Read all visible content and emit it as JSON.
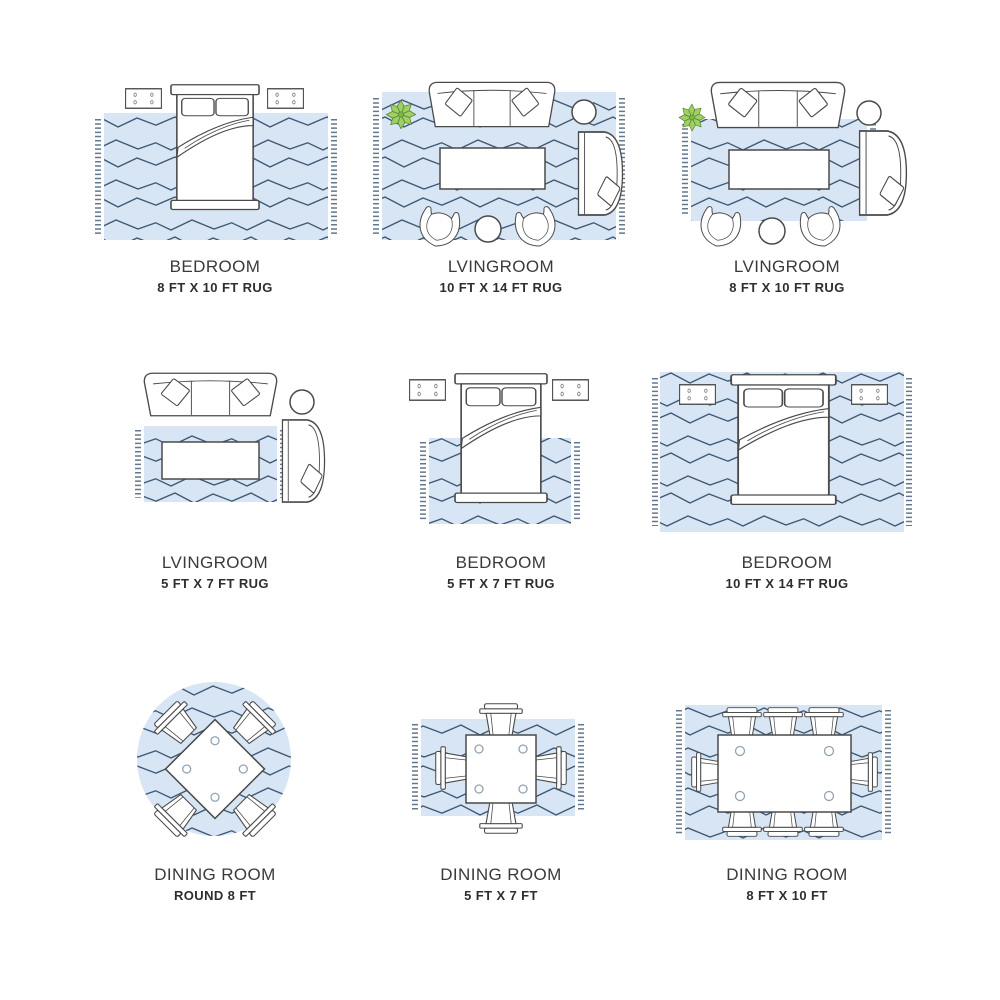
{
  "colors": {
    "rug_fill": "#d7e5f4",
    "rug_pattern_line": "#3d5772",
    "furniture_outline": "#4a4a4a",
    "plant_green": "#9ed063",
    "label_text": "#3a3a3a"
  },
  "cells": [
    {
      "room": "BEDROOM",
      "size": "8 FT X 10 FT RUG",
      "illustration": "bed-with-nightstands-rug-under-lower-bed"
    },
    {
      "room": "LVINGROOM",
      "size": "10 FT X 14 FT RUG",
      "illustration": "sofa-armchair-accent-chairs-coffee-table-all-on-rug"
    },
    {
      "room": "LVINGROOM",
      "size": "8 FT X 10 FT RUG",
      "illustration": "sofa-and-chairs-front-legs-on-rug"
    },
    {
      "room": "LVINGROOM",
      "size": "5 FT X 7 FT RUG",
      "illustration": "rug-under-coffee-table-only"
    },
    {
      "room": "BEDROOM",
      "size": "5 FT X 7 FT RUG",
      "illustration": "bed-rug-under-lower-two-thirds"
    },
    {
      "room": "BEDROOM",
      "size": "10 FT X 14 FT RUG",
      "illustration": "bed-and-nightstands-fully-on-rug"
    },
    {
      "room": "DINING ROOM",
      "size": "ROUND 8 FT",
      "illustration": "square-table-four-chairs-round-rug"
    },
    {
      "room": "DINING ROOM",
      "size": "5 FT X 7 FT",
      "illustration": "table-four-chairs-small-rug"
    },
    {
      "room": "DINING ROOM",
      "size": "8 FT X 10 FT",
      "illustration": "table-eight-chairs-large-rug"
    }
  ]
}
